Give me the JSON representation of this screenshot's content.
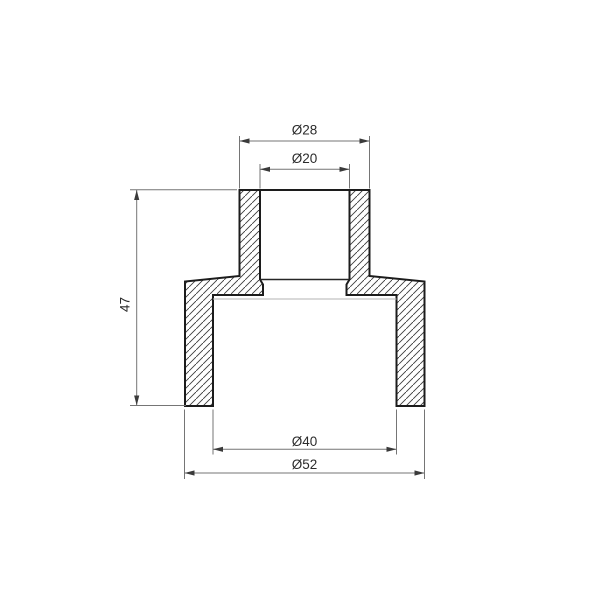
{
  "drawing": {
    "title": "pipe-reducing-coupling-cross-section",
    "view": "full section, hatched walls",
    "dimensions": {
      "top_outer": "Ø28",
      "top_inner": "Ø20",
      "height": "47",
      "bottom_inner": "Ø40",
      "bottom_outer": "Ø52"
    },
    "colors": {
      "background": "#ffffff",
      "outline": "#1c1c1c",
      "hatch": "#3d3d3d",
      "dimension_line": "#757575",
      "arrow": "#3a3a3a",
      "text": "#2b2b2b",
      "far_edge": "#b3b3b3"
    }
  }
}
